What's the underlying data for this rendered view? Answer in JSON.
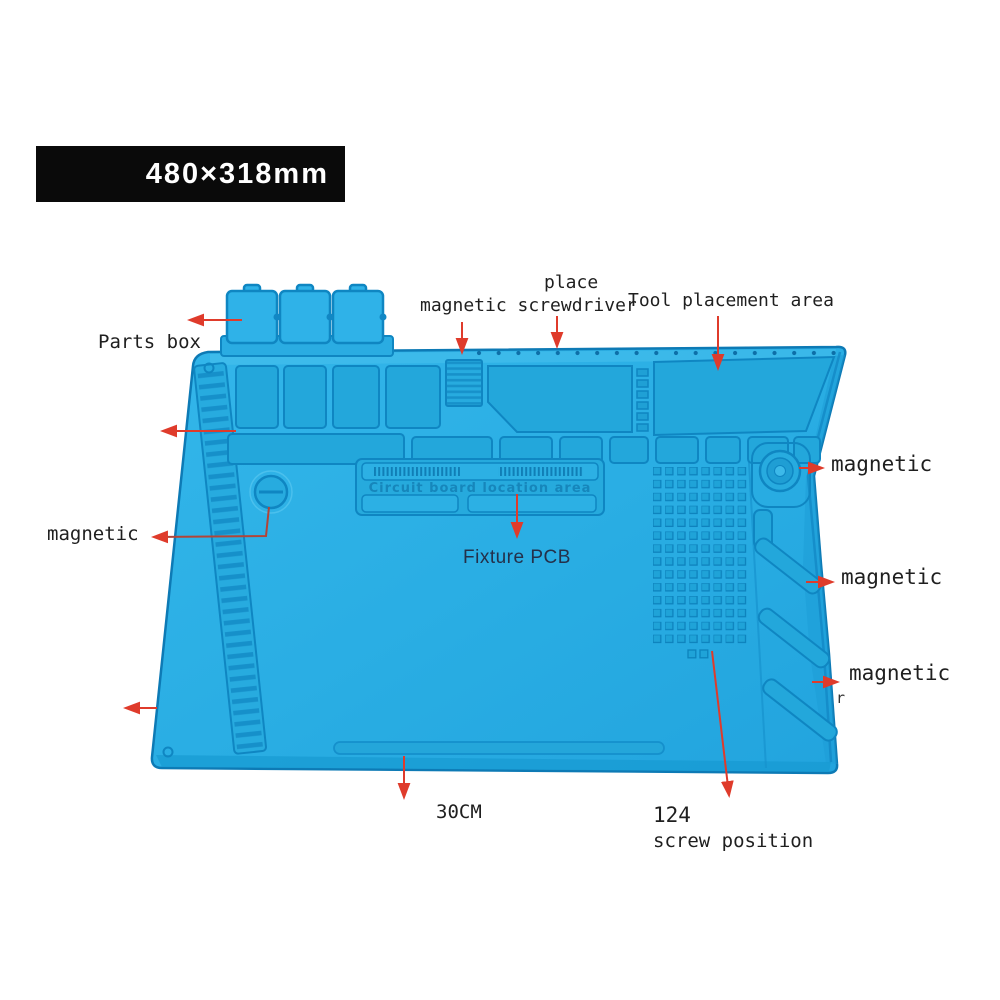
{
  "badge": {
    "text": "480×318mm"
  },
  "annotations": {
    "parts_box": "Parts box",
    "place_line1": "place",
    "place_line2": "magnetic screwdriver",
    "tool_placement": "Tool placement area",
    "magnetic_right_top": "magnetic",
    "magnetic_right_middle": "magnetic",
    "magnetic_right_bottom": "magnetic",
    "magnetic_left": "magnetic",
    "fixture_pcb": "Fixture PCB",
    "width_30cm": "30CM",
    "screw_count": "124",
    "screw_position": "screw position",
    "stray_mark": "r"
  },
  "mat": {
    "embossed_text": "Circuit board location area"
  },
  "colors": {
    "mat_blue": "#29ade3",
    "mat_ridge": "#0f86c2",
    "arrow_red": "#df3b2b",
    "badge_bg": "#0a0a0a",
    "badge_fg": "#ffffff",
    "label_color": "#1f1f1f"
  }
}
